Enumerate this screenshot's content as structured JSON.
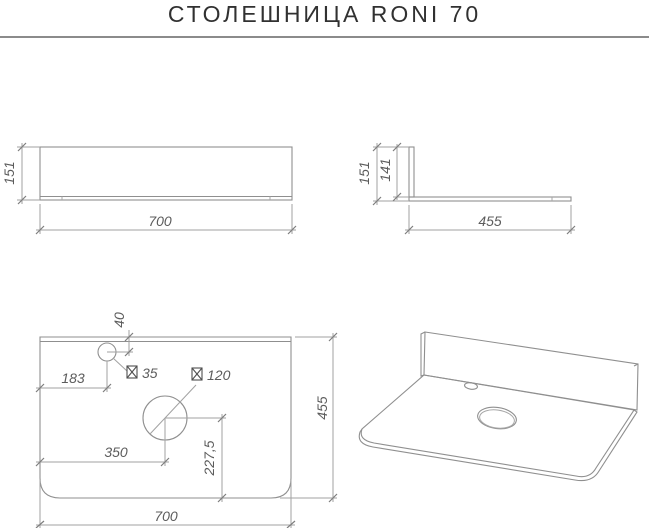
{
  "title": "СТОЛЕШНИЦА RONI 70",
  "views": {
    "front": {
      "height": "151",
      "width": "700"
    },
    "side": {
      "total_height": "151",
      "splash_height": "141",
      "depth": "455"
    },
    "top": {
      "faucet_hole_top_offset": "40",
      "faucet_hole_left_offset": "183",
      "faucet_hole_diameter": "35",
      "sink_hole_diameter": "120",
      "sink_hole_left_offset": "350",
      "sink_hole_bottom_offset": "227,5",
      "depth": "455",
      "width": "700"
    }
  }
}
